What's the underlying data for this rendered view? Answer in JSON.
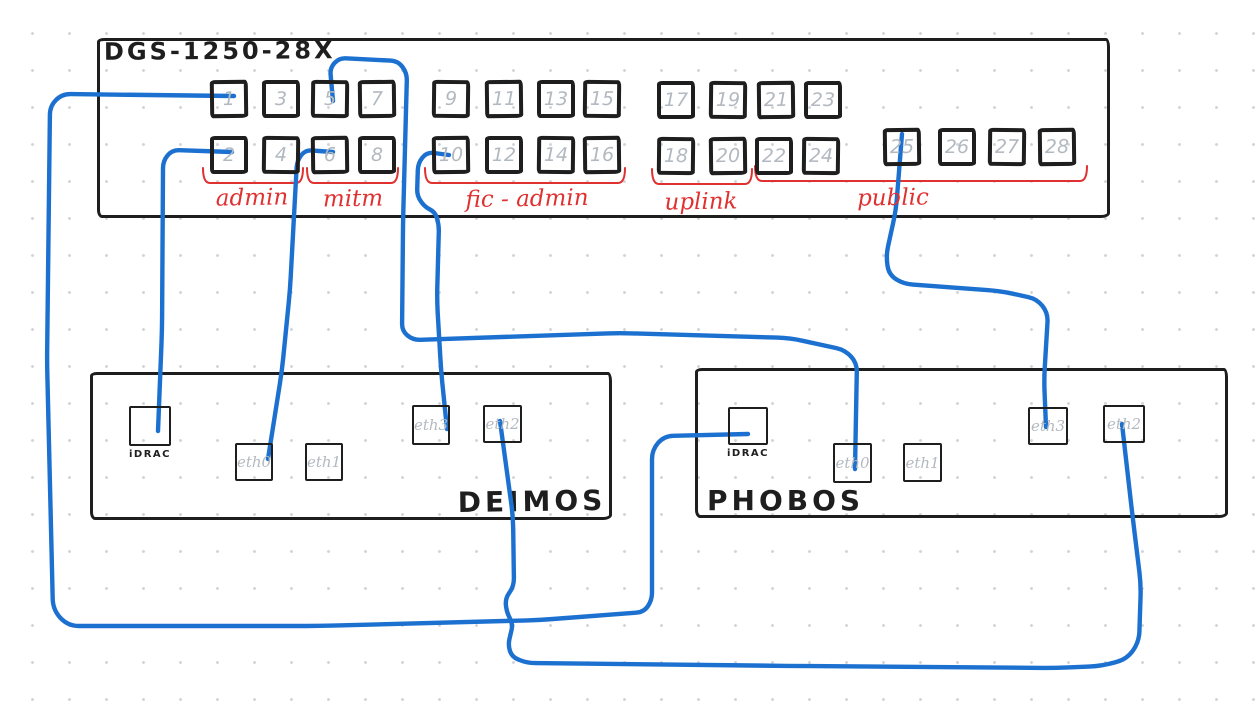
{
  "canvas": {
    "width": 1256,
    "height": 703,
    "background": "#ffffff",
    "grid_dot_color": "#d4d5d9",
    "grid_spacing": 37
  },
  "colors": {
    "ink": "#1e1e1e",
    "cable_blue": "#1c71d0",
    "bracket_red": "#e03131",
    "muted_gray": "#b3b9c0"
  },
  "switch": {
    "title": "DGS-1250-28X",
    "box": {
      "x": 97,
      "y": 38,
      "w": 1013,
      "h": 180
    },
    "title_pos": {
      "x": 101,
      "y": 34
    },
    "port_size": 38,
    "ports": [
      {
        "n": "1",
        "x": 210,
        "y": 80
      },
      {
        "n": "3",
        "x": 262,
        "y": 80
      },
      {
        "n": "5",
        "x": 311,
        "y": 80
      },
      {
        "n": "7",
        "x": 358,
        "y": 80
      },
      {
        "n": "2",
        "x": 210,
        "y": 136
      },
      {
        "n": "4",
        "x": 262,
        "y": 136
      },
      {
        "n": "6",
        "x": 311,
        "y": 136
      },
      {
        "n": "8",
        "x": 358,
        "y": 136
      },
      {
        "n": "9",
        "x": 432,
        "y": 80
      },
      {
        "n": "11",
        "x": 485,
        "y": 80
      },
      {
        "n": "13",
        "x": 537,
        "y": 80
      },
      {
        "n": "15",
        "x": 583,
        "y": 80
      },
      {
        "n": "10",
        "x": 432,
        "y": 136
      },
      {
        "n": "12",
        "x": 485,
        "y": 136
      },
      {
        "n": "14",
        "x": 537,
        "y": 136
      },
      {
        "n": "16",
        "x": 583,
        "y": 136
      },
      {
        "n": "17",
        "x": 657,
        "y": 81
      },
      {
        "n": "19",
        "x": 709,
        "y": 81
      },
      {
        "n": "21",
        "x": 757,
        "y": 81
      },
      {
        "n": "23",
        "x": 804,
        "y": 81
      },
      {
        "n": "18",
        "x": 657,
        "y": 137
      },
      {
        "n": "20",
        "x": 709,
        "y": 137
      },
      {
        "n": "22",
        "x": 755,
        "y": 137
      },
      {
        "n": "24",
        "x": 802,
        "y": 137
      },
      {
        "n": "25",
        "x": 883,
        "y": 128
      },
      {
        "n": "26",
        "x": 938,
        "y": 128
      },
      {
        "n": "27",
        "x": 988,
        "y": 128
      },
      {
        "n": "28",
        "x": 1038,
        "y": 128
      }
    ],
    "groups": [
      {
        "label": "admin",
        "x1": 203,
        "x2": 303,
        "y": 183,
        "lx": 252,
        "ly": 185
      },
      {
        "label": "mitm",
        "x1": 307,
        "x2": 398,
        "y": 183,
        "lx": 353,
        "ly": 186
      },
      {
        "label": "fic - admin",
        "x1": 425,
        "x2": 625,
        "y": 183,
        "lx": 527,
        "ly": 186
      },
      {
        "label": "uplink",
        "x1": 652,
        "x2": 752,
        "y": 184,
        "lx": 701,
        "ly": 189
      },
      {
        "label": "public",
        "x1": 755,
        "x2": 1087,
        "y": 181,
        "lx": 893,
        "ly": 185
      }
    ]
  },
  "servers": [
    {
      "name": "DEIMOS",
      "box": {
        "x": 90,
        "y": 372,
        "w": 522,
        "h": 148
      },
      "name_pos": {
        "x": 532,
        "y": 485,
        "align": "center"
      },
      "ports": [
        {
          "label": "iDRAC",
          "style": "idrac",
          "x": 129,
          "y": 406,
          "w": 42,
          "h": 40
        },
        {
          "label": "eth0",
          "style": "eth",
          "x": 235,
          "y": 443,
          "w": 38,
          "h": 38
        },
        {
          "label": "eth1",
          "style": "eth",
          "x": 305,
          "y": 443,
          "w": 38,
          "h": 38
        },
        {
          "label": "eth3",
          "style": "eth",
          "x": 412,
          "y": 405,
          "w": 38,
          "h": 40
        },
        {
          "label": "eth2",
          "style": "eth",
          "x": 483,
          "y": 405,
          "w": 39,
          "h": 38
        }
      ]
    },
    {
      "name": "PHOBOS",
      "box": {
        "x": 695,
        "y": 368,
        "w": 533,
        "h": 150
      },
      "name_pos": {
        "x": 707,
        "y": 484,
        "align": "left"
      },
      "ports": [
        {
          "label": "iDRAC",
          "style": "idrac",
          "x": 728,
          "y": 407,
          "w": 40,
          "h": 38
        },
        {
          "label": "eth0",
          "style": "eth",
          "x": 833,
          "y": 443,
          "w": 39,
          "h": 40
        },
        {
          "label": "eth1",
          "style": "eth",
          "x": 903,
          "y": 443,
          "w": 39,
          "h": 39
        },
        {
          "label": "eth3",
          "style": "eth",
          "x": 1028,
          "y": 407,
          "w": 40,
          "h": 38
        },
        {
          "label": "eth2",
          "style": "eth",
          "x": 1103,
          "y": 405,
          "w": 42,
          "h": 38
        }
      ]
    }
  ],
  "cables": [
    {
      "id": "cable-sw1-phobos-idrac",
      "from": "switch-port-1",
      "to": "phobos-idrac",
      "points": [
        [
          234,
          96
        ],
        [
          62,
          94
        ],
        [
          50,
          106
        ],
        [
          47,
          360
        ],
        [
          53,
          610
        ],
        [
          68,
          626
        ],
        [
          320,
          626
        ],
        [
          540,
          620
        ],
        [
          644,
          612
        ],
        [
          652,
          600
        ],
        [
          652,
          450
        ],
        [
          664,
          436
        ],
        [
          748,
          434
        ]
      ]
    },
    {
      "id": "cable-sw2-deimos-idrac",
      "from": "switch-port-2",
      "to": "deimos-idrac",
      "points": [
        [
          232,
          152
        ],
        [
          172,
          150
        ],
        [
          163,
          161
        ],
        [
          162,
          330
        ],
        [
          158,
          431
        ]
      ]
    },
    {
      "id": "cable-sw5-phobos-eth0",
      "from": "switch-port-5",
      "to": "phobos-eth0",
      "points": [
        [
          333,
          101
        ],
        [
          330,
          68
        ],
        [
          339,
          58
        ],
        [
          398,
          61
        ],
        [
          407,
          73
        ],
        [
          403,
          225
        ],
        [
          402,
          331
        ],
        [
          413,
          340
        ],
        [
          620,
          333
        ],
        [
          790,
          338
        ],
        [
          845,
          350
        ],
        [
          857,
          363
        ],
        [
          855,
          469
        ]
      ]
    },
    {
      "id": "cable-sw6-deimos-eth0",
      "from": "switch-port-6",
      "to": "deimos-eth0",
      "points": [
        [
          333,
          152
        ],
        [
          305,
          150
        ],
        [
          297,
          161
        ],
        [
          290,
          290
        ],
        [
          282,
          370
        ],
        [
          268,
          459
        ]
      ]
    },
    {
      "id": "cable-sw10-deimos-eth3",
      "from": "switch-port-10",
      "to": "deimos-eth3",
      "points": [
        [
          449,
          155
        ],
        [
          427,
          152
        ],
        [
          418,
          163
        ],
        [
          417,
          196
        ],
        [
          425,
          207
        ],
        [
          435,
          212
        ],
        [
          439,
          225
        ],
        [
          437,
          300
        ],
        [
          441,
          370
        ],
        [
          447,
          429
        ]
      ]
    },
    {
      "id": "cable-sw25-phobos-eth3",
      "from": "switch-port-25",
      "to": "phobos-eth3",
      "points": [
        [
          902,
          134
        ],
        [
          896,
          210
        ],
        [
          886,
          256
        ],
        [
          889,
          275
        ],
        [
          904,
          284
        ],
        [
          1000,
          291
        ],
        [
          1037,
          299
        ],
        [
          1048,
          313
        ],
        [
          1044,
          380
        ],
        [
          1046,
          427
        ]
      ]
    },
    {
      "id": "cable-deimos-eth2-phobos-eth2",
      "from": "deimos-eth2",
      "to": "phobos-eth2",
      "points": [
        [
          500,
          421
        ],
        [
          513,
          516
        ],
        [
          514,
          586
        ],
        [
          505,
          599
        ],
        [
          507,
          613
        ],
        [
          513,
          624
        ],
        [
          508,
          645
        ],
        [
          512,
          657
        ],
        [
          527,
          663
        ],
        [
          800,
          666
        ],
        [
          1055,
          668
        ],
        [
          1102,
          666
        ],
        [
          1127,
          659
        ],
        [
          1139,
          642
        ],
        [
          1141,
          585
        ],
        [
          1133,
          520
        ],
        [
          1122,
          424
        ]
      ]
    }
  ]
}
